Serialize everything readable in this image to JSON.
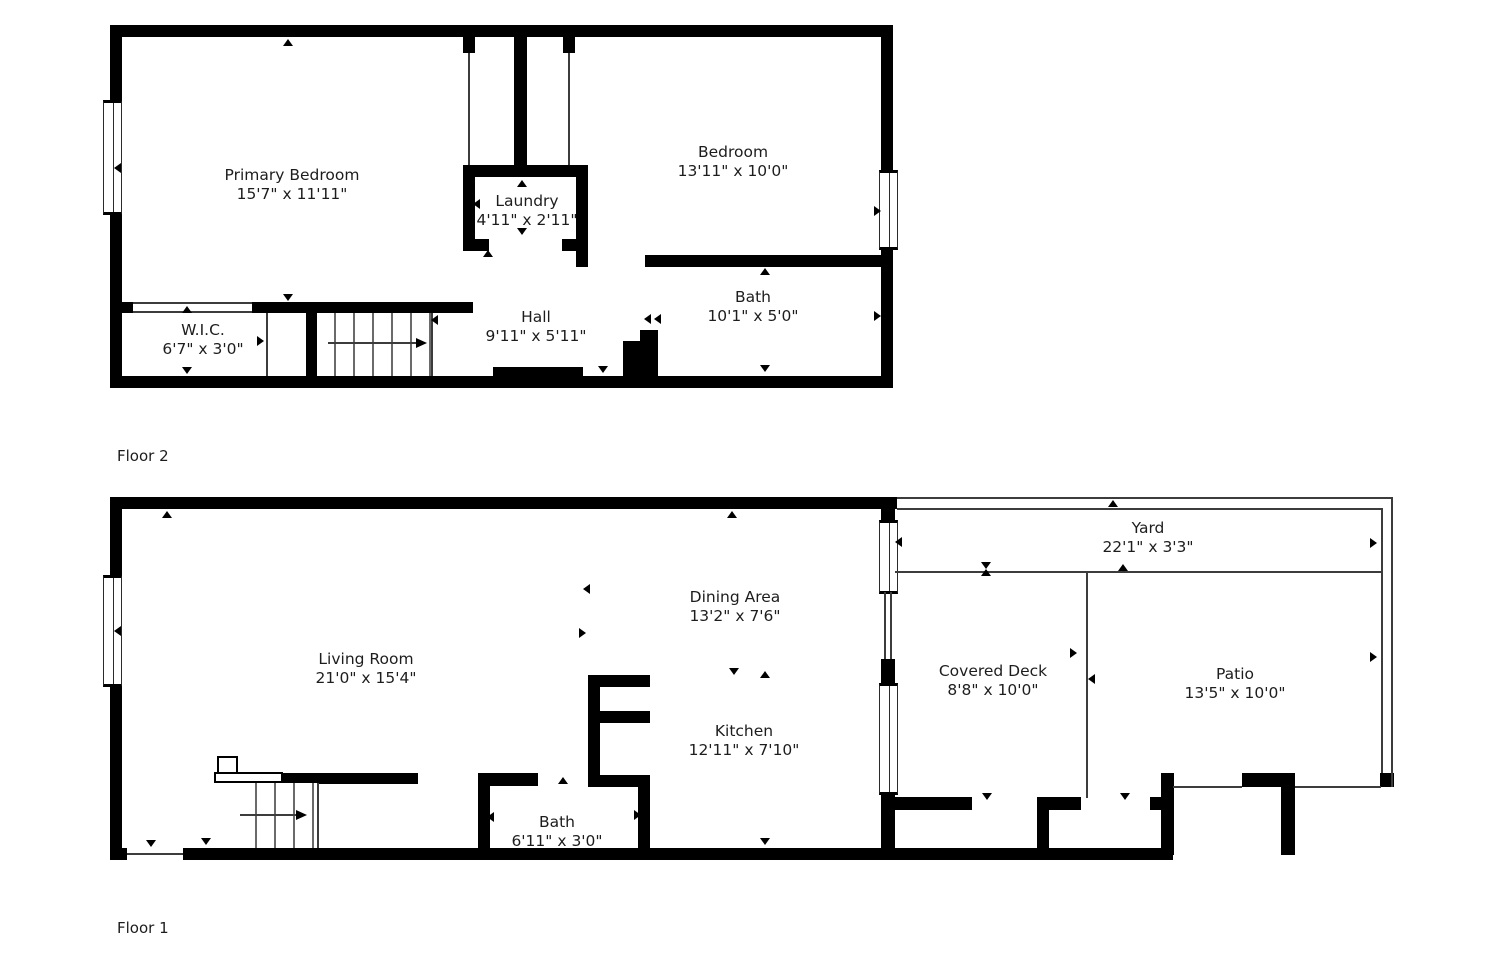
{
  "colors": {
    "wall": "#000000",
    "background": "#ffffff",
    "thin_line": "#3c3c3c",
    "text": "#1d1d1d"
  },
  "floors": [
    {
      "label": "Floor 2",
      "rooms": [
        {
          "name": "Primary Bedroom",
          "dims": "15'7\" x 11'11\""
        },
        {
          "name": "Laundry",
          "dims": "4'11\" x 2'11\""
        },
        {
          "name": "Bedroom",
          "dims": "13'11\" x 10'0\""
        },
        {
          "name": "W.I.C.",
          "dims": "6'7\" x 3'0\""
        },
        {
          "name": "Hall",
          "dims": "9'11\" x 5'11\""
        },
        {
          "name": "Bath",
          "dims": "10'1\" x 5'0\""
        }
      ]
    },
    {
      "label": "Floor 1",
      "rooms": [
        {
          "name": "Living Room",
          "dims": "21'0\" x 15'4\""
        },
        {
          "name": "Dining Area",
          "dims": "13'2\" x 7'6\""
        },
        {
          "name": "Kitchen",
          "dims": "12'11\" x 7'10\""
        },
        {
          "name": "Bath",
          "dims": "6'11\" x 3'0\""
        },
        {
          "name": "Covered Deck",
          "dims": "8'8\" x 10'0\""
        },
        {
          "name": "Patio",
          "dims": "13'5\" x 10'0\""
        },
        {
          "name": "Yard",
          "dims": "22'1\" x 3'3\""
        }
      ]
    }
  ]
}
